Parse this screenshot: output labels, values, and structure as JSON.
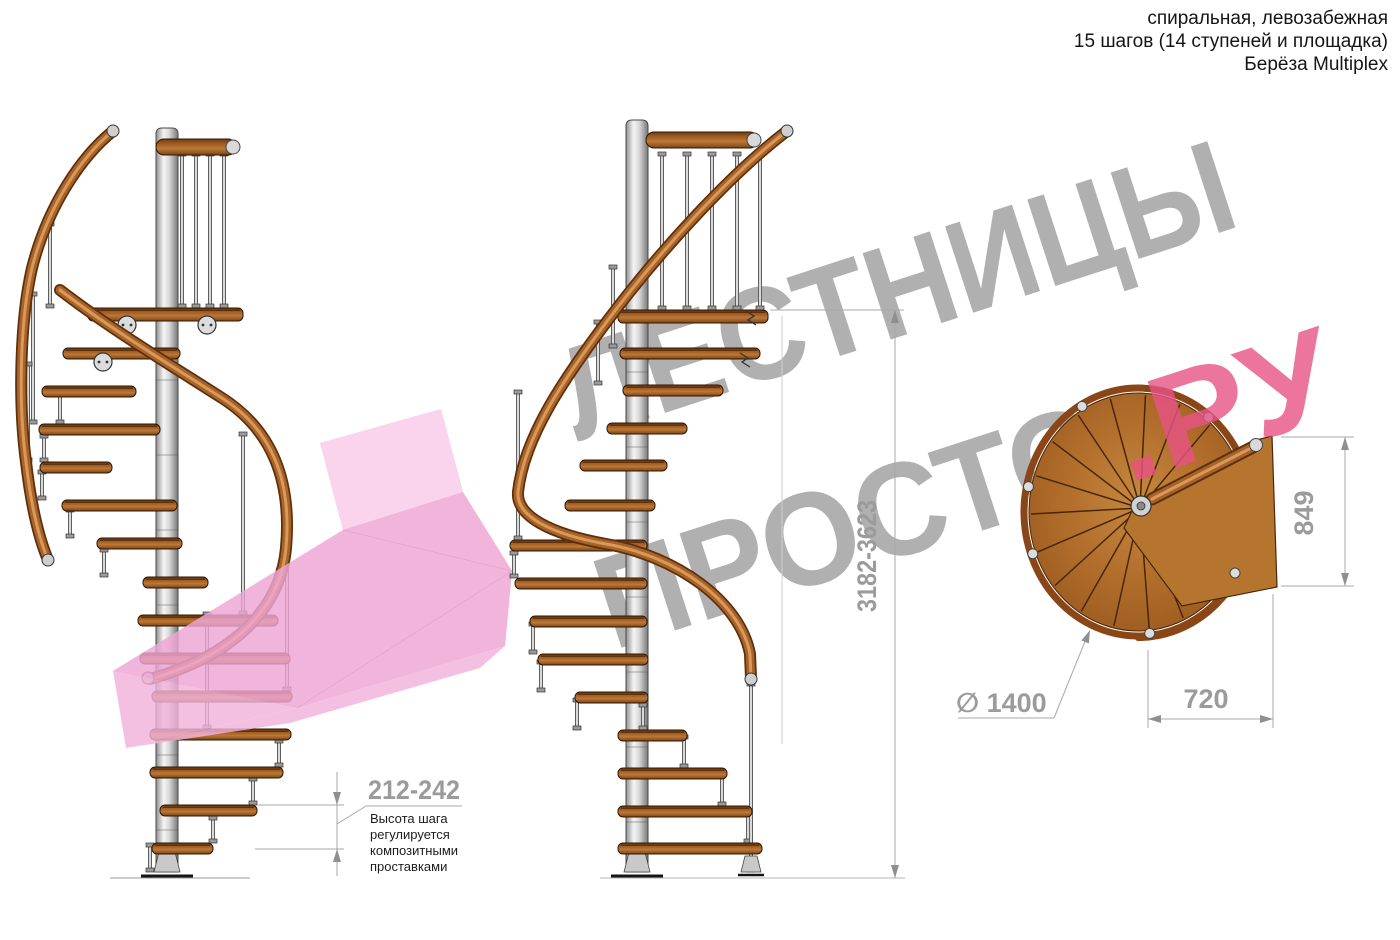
{
  "header": {
    "line1": "спиральная, левозабежная",
    "line2": "15 шагов (14 ступеней и площадка)",
    "line3": "Берёза Multiplex"
  },
  "watermark": {
    "line1": "ЛЕСТНИЦЫ",
    "line2_gray": "ПРОСТО",
    "line2_pink": ".РУ"
  },
  "dimensions": {
    "step_height": "212-242",
    "total_height": "3182-3623",
    "diameter": "∅ 1400",
    "platform_width": "720",
    "platform_depth": "849"
  },
  "annotation": {
    "line1": "Высота шага",
    "line2": "регулируется",
    "line3": "композитными",
    "line4": "проставками"
  },
  "colors": {
    "dim_gray": "#9b9b9b",
    "dim_line": "#a8a8a8",
    "arrow_fill": "#8f8f8f",
    "watermark_gray": "#9b9b9b",
    "watermark_pink": "#e85385",
    "arrow_pink_base": "#f2b3db",
    "arrow_pink_light": "#f8cbe8",
    "arrow_pink_mid": "#efa6d5",
    "wood_dark": "#5e2f0c",
    "wood_mid": "#a86327",
    "wood_light": "#d9985c",
    "tread_outline": "#2e1704",
    "plan_ring": "#8a4616",
    "plan_line": "#4a2506",
    "plan_platform": "#b5752f",
    "steel_light": "#d9d9d9",
    "steel_dark": "#555555"
  }
}
